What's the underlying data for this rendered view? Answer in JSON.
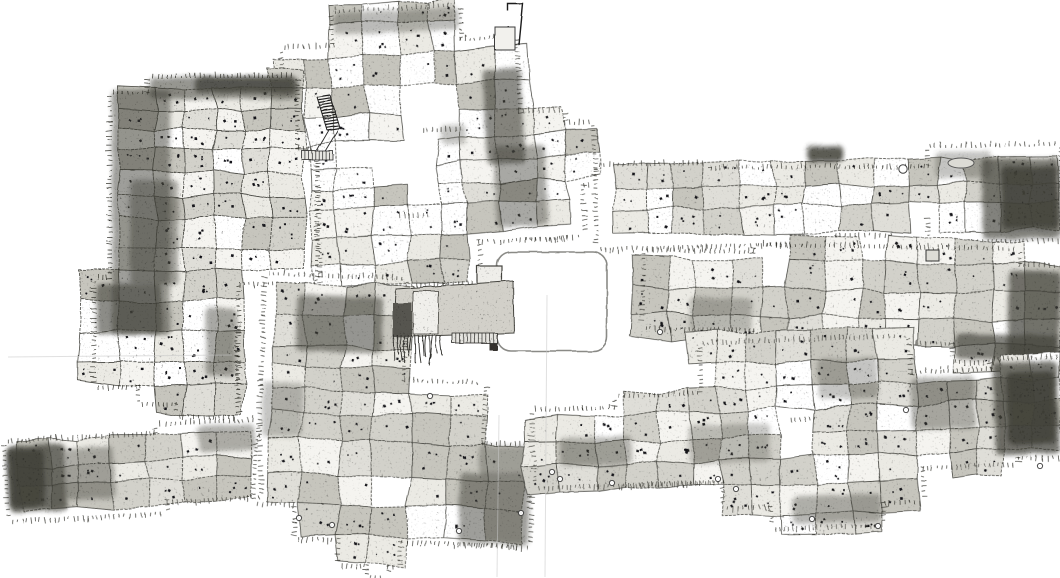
{
  "meta": {
    "label": "hand-drawn settlement plan",
    "canvas": {
      "width": 1060,
      "height": 578
    },
    "background": "#ffffff"
  },
  "palette": {
    "ink": "#26261f",
    "wall": "#4a4a44",
    "smudge": "#403f38",
    "room_fills": [
      "#ffffff",
      "#f5f4f0",
      "#ebeae4",
      "#dfded8",
      "#d2d1ca",
      "#c6c5bd"
    ],
    "crease": "#c6c6c6"
  },
  "generator": {
    "seed": 20240613,
    "cell": {
      "min_w": 24,
      "max_w": 40,
      "min_h": 19,
      "max_h": 33
    },
    "corner_jitter": 3,
    "dot": {
      "min_size": 1.5,
      "max_size": 2.8,
      "max_per_room": 4
    },
    "tick": {
      "length": 4,
      "spacing": 4.5
    }
  },
  "clusters": [
    {
      "id": "top-center",
      "angle": -3,
      "shade_bias": 0.55,
      "rects": [
        [
          340,
          8,
          125,
          62
        ],
        [
          288,
          42,
          232,
          108
        ],
        [
          318,
          132,
          196,
          92
        ],
        [
          442,
          118,
          122,
          124
        ],
        [
          540,
          132,
          52,
          58
        ],
        [
          520,
          185,
          58,
          57
        ],
        [
          316,
          216,
          156,
          66
        ]
      ],
      "holes": [
        [
          352,
          128,
          68,
          56
        ],
        [
          419,
          93,
          37,
          40
        ],
        [
          393,
          188,
          34,
          26
        ]
      ],
      "dark": [
        [
          340,
          8,
          125,
          22,
          0.35
        ],
        [
          486,
          72,
          38,
          95,
          0.6
        ],
        [
          493,
          150,
          52,
          80,
          0.45
        ],
        [
          442,
          125,
          24,
          20,
          0.3
        ]
      ]
    },
    {
      "id": "left-west",
      "angle": 0,
      "shade_bias": 1.25,
      "rects": [
        [
          150,
          78,
          145,
          85
        ],
        [
          112,
          95,
          85,
          235
        ],
        [
          150,
          150,
          165,
          132
        ],
        [
          96,
          280,
          140,
          105
        ],
        [
          140,
          330,
          95,
          72
        ],
        [
          178,
          372,
          58,
          43
        ]
      ],
      "holes": [],
      "dark": [
        [
          150,
          77,
          148,
          22,
          0.55
        ],
        [
          195,
          77,
          100,
          16,
          0.75
        ],
        [
          112,
          90,
          58,
          245,
          0.5
        ],
        [
          130,
          180,
          48,
          105,
          0.45
        ],
        [
          96,
          284,
          66,
          50,
          0.6
        ],
        [
          206,
          308,
          30,
          68,
          0.45
        ]
      ]
    },
    {
      "id": "center-lower",
      "angle": 2,
      "shade_bias": 1.15,
      "rects": [
        [
          262,
          280,
          138,
          112
        ],
        [
          262,
          382,
          220,
          68
        ],
        [
          258,
          442,
          272,
          64
        ],
        [
          300,
          498,
          222,
          42
        ],
        [
          345,
          535,
          57,
          30
        ],
        [
          374,
          556,
          18,
          20
        ],
        [
          462,
          470,
          70,
          70
        ]
      ],
      "holes": [
        [
          375,
          490,
          18,
          14
        ]
      ],
      "dark": [
        [
          293,
          298,
          86,
          56,
          0.55
        ],
        [
          462,
          470,
          70,
          70,
          0.5
        ],
        [
          480,
          442,
          50,
          30,
          0.35
        ],
        [
          262,
          386,
          40,
          55,
          0.3
        ]
      ]
    },
    {
      "id": "bottom-left",
      "angle": -3,
      "shade_bias": 1.25,
      "rects": [
        [
          8,
          437,
          156,
          76
        ],
        [
          160,
          428,
          98,
          74
        ]
      ],
      "holes": [],
      "dark": [
        [
          8,
          440,
          58,
          66,
          0.75
        ],
        [
          10,
          444,
          34,
          58,
          0.85
        ],
        [
          66,
          445,
          48,
          52,
          0.4
        ],
        [
          200,
          430,
          56,
          26,
          0.4
        ]
      ]
    },
    {
      "id": "top-right",
      "angle": -1,
      "shade_bias": 1.0,
      "rects": [
        [
          598,
          163,
          110,
          80
        ],
        [
          694,
          168,
          140,
          74
        ],
        [
          834,
          170,
          112,
          64
        ],
        [
          930,
          150,
          130,
          92
        ]
      ],
      "holes": [
        [
          893,
          218,
          36,
          26
        ]
      ],
      "dark": [
        [
          808,
          146,
          36,
          16,
          0.85
        ],
        [
          982,
          162,
          78,
          80,
          0.65
        ],
        [
          1002,
          170,
          56,
          62,
          0.8
        ],
        [
          936,
          154,
          56,
          26,
          0.3
        ]
      ]
    },
    {
      "id": "middle-right",
      "angle": 1,
      "shade_bias": 1.15,
      "rects": [
        [
          645,
          256,
          116,
          74
        ],
        [
          755,
          248,
          262,
          92
        ],
        [
          1008,
          264,
          52,
          94
        ],
        [
          955,
          330,
          105,
          28
        ]
      ],
      "holes": [
        [
          755,
          268,
          28,
          28
        ]
      ],
      "dark": [
        [
          1008,
          268,
          52,
          88,
          0.7
        ],
        [
          956,
          332,
          102,
          25,
          0.65
        ],
        [
          690,
          300,
          62,
          34,
          0.3
        ]
      ]
    },
    {
      "id": "bottom-right",
      "angle": -2,
      "shade_bias": 1.2,
      "rects": [
        [
          705,
          342,
          205,
          76
        ],
        [
          723,
          392,
          196,
          112
        ],
        [
          535,
          403,
          196,
          74
        ],
        [
          618,
          392,
          122,
          86
        ],
        [
          912,
          378,
          102,
          92
        ],
        [
          995,
          368,
          66,
          96
        ],
        [
          770,
          500,
          108,
          26
        ]
      ],
      "holes": [
        [
          790,
          418,
          28,
          30
        ]
      ],
      "dark": [
        [
          995,
          370,
          64,
          92,
          0.72
        ],
        [
          1008,
          380,
          48,
          72,
          0.85
        ],
        [
          912,
          382,
          64,
          52,
          0.4
        ],
        [
          560,
          430,
          72,
          28,
          0.35
        ],
        [
          688,
          422,
          82,
          38,
          0.28
        ],
        [
          790,
          496,
          88,
          28,
          0.38
        ],
        [
          820,
          360,
          60,
          40,
          0.3
        ]
      ]
    }
  ],
  "features": {
    "plaza": {
      "x": 497,
      "y": 252,
      "w": 110,
      "h": 99,
      "rx": 14,
      "stroke": "#8a8a86",
      "stroke_width": 1.6
    },
    "annex": {
      "bar_points": [
        [
          396,
          289
        ],
        [
          513,
          281
        ],
        [
          514,
          333
        ],
        [
          394,
          337
        ]
      ],
      "bar_fill": "#d2d0c9",
      "west_block": {
        "x": 393,
        "y": 303,
        "w": 19,
        "h": 34,
        "fill": "#57554f"
      },
      "light_block": {
        "x": 413,
        "y": 291,
        "w": 25,
        "h": 43,
        "fill": "#f0efeb"
      },
      "top_square": {
        "x": 477,
        "y": 266,
        "w": 25,
        "h": 22,
        "fill": "#efeeea"
      },
      "foot": {
        "x": 489,
        "y": 334,
        "w": 8,
        "h": 16,
        "fill": "#34332e"
      },
      "fringe": {
        "x0": 394,
        "x1": 440,
        "y": 335,
        "len_min": 18,
        "len_max": 30,
        "count": 14
      },
      "strip": {
        "x": 452,
        "y": 333,
        "w": 45,
        "h": 10,
        "ticks": 12
      }
    },
    "stair": {
      "x": 317,
      "y": 97,
      "w": 13,
      "dx": 10,
      "dy": 33,
      "steps": 12,
      "corridor_end": [
        315,
        154
      ],
      "base": {
        "x": 302,
        "y": 151,
        "w": 31,
        "h": 9,
        "ticks": 9
      }
    },
    "flag": {
      "points": [
        [
          508,
          11
        ],
        [
          508,
          4
        ],
        [
          523,
          4
        ],
        [
          519,
          45
        ]
      ],
      "square": {
        "x": 495,
        "y": 27,
        "w": 20,
        "h": 23,
        "fill": "#f2f1ed"
      }
    },
    "small_square": {
      "x": 926,
      "y": 250,
      "w": 13,
      "h": 11,
      "fill": "#dddcd6"
    },
    "ellipse": {
      "cx": 961,
      "cy": 163,
      "rx": 13,
      "ry": 5,
      "fill": "#dcdbd5"
    },
    "big_circle": {
      "cx": 903,
      "cy": 169,
      "r": 4.2
    },
    "pivots": [
      [
        430,
        396
      ],
      [
        299,
        518
      ],
      [
        332,
        525
      ],
      [
        459,
        531
      ],
      [
        521,
        513
      ],
      [
        560,
        479
      ],
      [
        612,
        483
      ],
      [
        718,
        479
      ],
      [
        812,
        519
      ],
      [
        878,
        526
      ],
      [
        660,
        332
      ],
      [
        906,
        410
      ],
      [
        1040,
        466
      ],
      [
        736,
        489
      ],
      [
        552,
        472
      ]
    ],
    "creases": [
      [
        547,
        295,
        545,
        577
      ],
      [
        8,
        357,
        232,
        355
      ],
      [
        499,
        415,
        497,
        577
      ]
    ]
  }
}
